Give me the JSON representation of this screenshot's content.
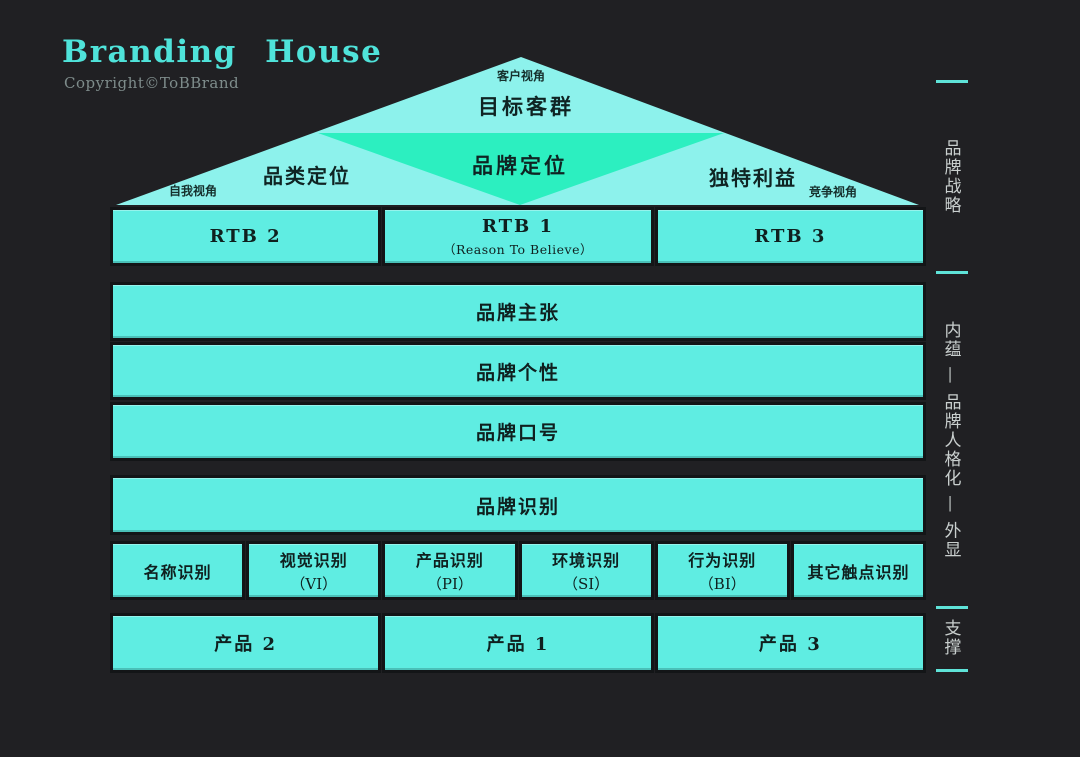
{
  "header": {
    "title": "Branding House",
    "copyright": "Copyright©ToBBrand"
  },
  "roof": {
    "apex_note": "客户视角",
    "top_label": "目标客群",
    "center_label": "品牌定位",
    "left_label": "品类定位",
    "right_label": "独特利益",
    "left_note": "自我视角",
    "right_note": "竞争视角"
  },
  "rtb_row": [
    {
      "label": "RTB 2",
      "sub": ""
    },
    {
      "label": "RTB 1",
      "sub": "（Reason To Believe）"
    },
    {
      "label": "RTB 3",
      "sub": ""
    }
  ],
  "bars": [
    {
      "label": "品牌主张"
    },
    {
      "label": "品牌个性"
    },
    {
      "label": "品牌口号"
    }
  ],
  "identity_bar": {
    "label": "品牌识别"
  },
  "identity_row": [
    {
      "line1": "名称识别",
      "line2": ""
    },
    {
      "line1": "视觉识别",
      "line2": "（VI）"
    },
    {
      "line1": "产品识别",
      "line2": "（PI）"
    },
    {
      "line1": "环境识别",
      "line2": "（SI）"
    },
    {
      "line1": "行为识别",
      "line2": "（BI）"
    },
    {
      "line1": "其它触点识别",
      "line2": ""
    }
  ],
  "product_row": [
    {
      "label": "产品 2"
    },
    {
      "label": "产品 1"
    },
    {
      "label": "产品 3"
    }
  ],
  "sidebar": {
    "sections": [
      {
        "label": "品牌战略"
      },
      {
        "label": "内蕴 — 品牌人格化 — 外显"
      },
      {
        "label": "支撑"
      }
    ]
  },
  "colors": {
    "background": "#202023",
    "box_cyan": "#5fede2",
    "roof_cyan": "#8df2ec",
    "diamond_green": "#2cefc0",
    "title_cyan": "#4fe3da",
    "side_text": "#c9cfce",
    "dash": "#5fe3d8",
    "dark_text": "#0f201f"
  }
}
